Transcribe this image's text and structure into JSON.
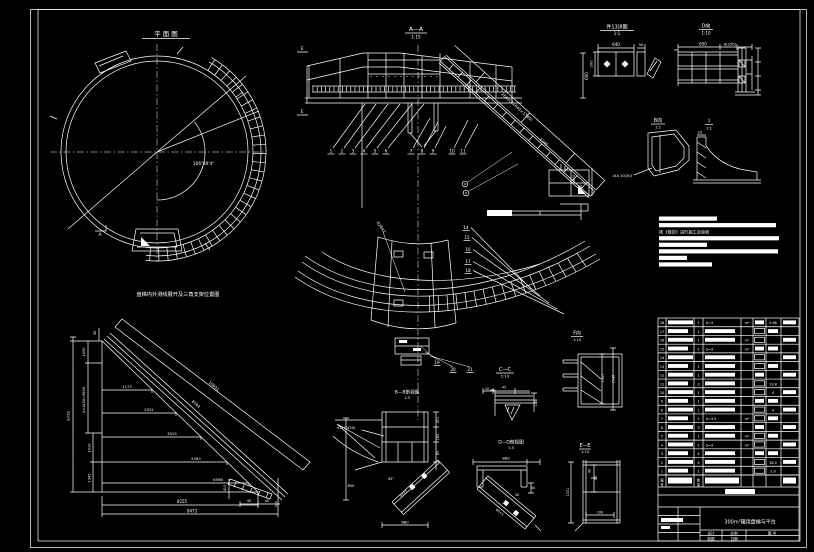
{
  "page": {
    "bg": "#000000",
    "line": "#ffffff"
  },
  "plan": {
    "title": "平 面 图",
    "angle": "106°49'4\"",
    "marker_a": "A"
  },
  "elevation": {
    "title": "A—A",
    "scale": "1:15",
    "dim_600": "600",
    "stair_dim": "2642(2×645×1540)",
    "dim_1245": "1245",
    "dim_410": "410",
    "dim_1160": "1160",
    "marker_e_top": "E",
    "marker_e_bottom": "E",
    "callouts": [
      "1",
      "2",
      "3",
      "4",
      "5",
      "6",
      "7",
      "8",
      "9",
      "10",
      "11"
    ]
  },
  "detail13": {
    "title": "件13详图",
    "scale": "1:1",
    "dim_640": "640",
    "dim_50": "50",
    "dim_200": "200"
  },
  "view_d": {
    "title": "D向",
    "scale": "1:10",
    "dim_650": "650",
    "dim_6x150": "6(150)"
  },
  "view_b": {
    "title": "B向",
    "scale": "1:1",
    "label": "14A 10(30)"
  },
  "detail_i": {
    "title": "I",
    "scale": "1:1",
    "dim_10": "10"
  },
  "notes": {
    "lines": [
      {
        "w": 58
      },
      {
        "w": 117
      },
      {
        "text": "按《规范》进行施工及验收"
      },
      {
        "w": 120
      },
      {
        "w": 48
      },
      {
        "w": 119
      },
      {
        "w": 28
      },
      {
        "w": 53
      }
    ]
  },
  "section_cc": {
    "title": "C—C",
    "scale": "1:10",
    "radius": "R2642",
    "callouts": [
      "14",
      "15",
      "16",
      "17",
      "18"
    ],
    "callouts_bottom": [
      "19",
      "20",
      "21"
    ]
  },
  "development": {
    "title": "盘梯内外测线展开及三角支架位置图",
    "steps": [
      "1173",
      "2531",
      "3915",
      "5283",
      "6598"
    ],
    "bottom1": "8255",
    "bottom2": "9473",
    "v1": "1450",
    "v2": "4×1450=5800",
    "v3": "1410",
    "v4": "1345",
    "total": "9775",
    "top": "50",
    "hyp_outer": "10951",
    "hyp_inner": "8784",
    "d40a": "40",
    "d40b": "40",
    "d410": "410"
  },
  "section_bb": {
    "title": "B—B剖视图",
    "scale": "1:5",
    "dim_880": "880",
    "dim_850": "850",
    "dim_45": "45°",
    "dim_411": "411",
    "dim_160": "160",
    "dim_80": "80",
    "bolt": "4-M10(20)",
    "ch": "60×5"
  },
  "section_dd": {
    "title": "D—D剖视图",
    "scale": "1:5",
    "dim_880": "880",
    "dim_30": "30",
    "dim_50": "50",
    "ch": "60×5"
  },
  "mini": {
    "dim_10": "10",
    "dim_45": "45",
    "dim_130": "130"
  },
  "view_f": {
    "title": "F向",
    "scale": "1:10",
    "dim_1001": "1001",
    "dim_1140": "1140"
  },
  "section_ee": {
    "title": "E—E",
    "scale": "1:10",
    "dim_1001": "1001",
    "dim_80": "80",
    "dim_40": "40",
    "dim_100": "100"
  },
  "parts_list": {
    "header_no": "编号",
    "header_qty": "数量",
    "rows": [
      {
        "no": "18",
        "qty": "1",
        "spec": "δ=3",
        "unit": "m²",
        "wt": "0.66"
      },
      {
        "no": "17",
        "qty": "1",
        "spec": "",
        "unit": "",
        "wt": ""
      },
      {
        "no": "16",
        "qty": "1",
        "spec": "",
        "unit": "m²",
        "wt": ""
      },
      {
        "no": "15",
        "qty": "1",
        "spec": "δ=3",
        "unit": "m²",
        "wt": ""
      },
      {
        "no": "14",
        "qty": "",
        "spec": "",
        "unit": "",
        "wt": ""
      },
      {
        "no": "13",
        "qty": "1",
        "spec": "",
        "unit": "",
        "wt": ""
      },
      {
        "no": "12",
        "qty": "1",
        "spec": "",
        "unit": "",
        "wt": ""
      },
      {
        "no": "11",
        "qty": "3",
        "spec": "",
        "unit": "",
        "wt": "13.8"
      },
      {
        "no": "10",
        "qty": "1",
        "spec": "",
        "unit": "",
        "wt": "4"
      },
      {
        "no": "9",
        "qty": "1",
        "spec": "",
        "unit": "",
        "wt": ""
      },
      {
        "no": "8",
        "qty": "1",
        "spec": "",
        "unit": "",
        "wt": "4"
      },
      {
        "no": "7",
        "qty": "1",
        "spec": "δ=3.5",
        "unit": "m²",
        "wt": ""
      },
      {
        "no": "6",
        "qty": "3",
        "spec": "",
        "unit": "",
        "wt": ""
      },
      {
        "no": "5",
        "qty": "1",
        "spec": "",
        "unit": "m²",
        "wt": ""
      },
      {
        "no": "4",
        "qty": "1",
        "spec": "δ=3",
        "unit": "m²",
        "wt": ""
      },
      {
        "no": "3",
        "qty": "4",
        "spec": "",
        "unit": "",
        "wt": ""
      },
      {
        "no": "2",
        "qty": "4",
        "spec": "",
        "unit": "",
        "wt": "38.4"
      },
      {
        "no": "1",
        "qty": "1",
        "spec": "",
        "unit": "",
        "wt": "1.9"
      }
    ]
  },
  "title_block": {
    "title": "300m³罐用盘梯与平台",
    "design": "设计",
    "scale_lbl": "比例",
    "drawing_no": "图  号",
    "draft": "制图",
    "date": "日期"
  }
}
